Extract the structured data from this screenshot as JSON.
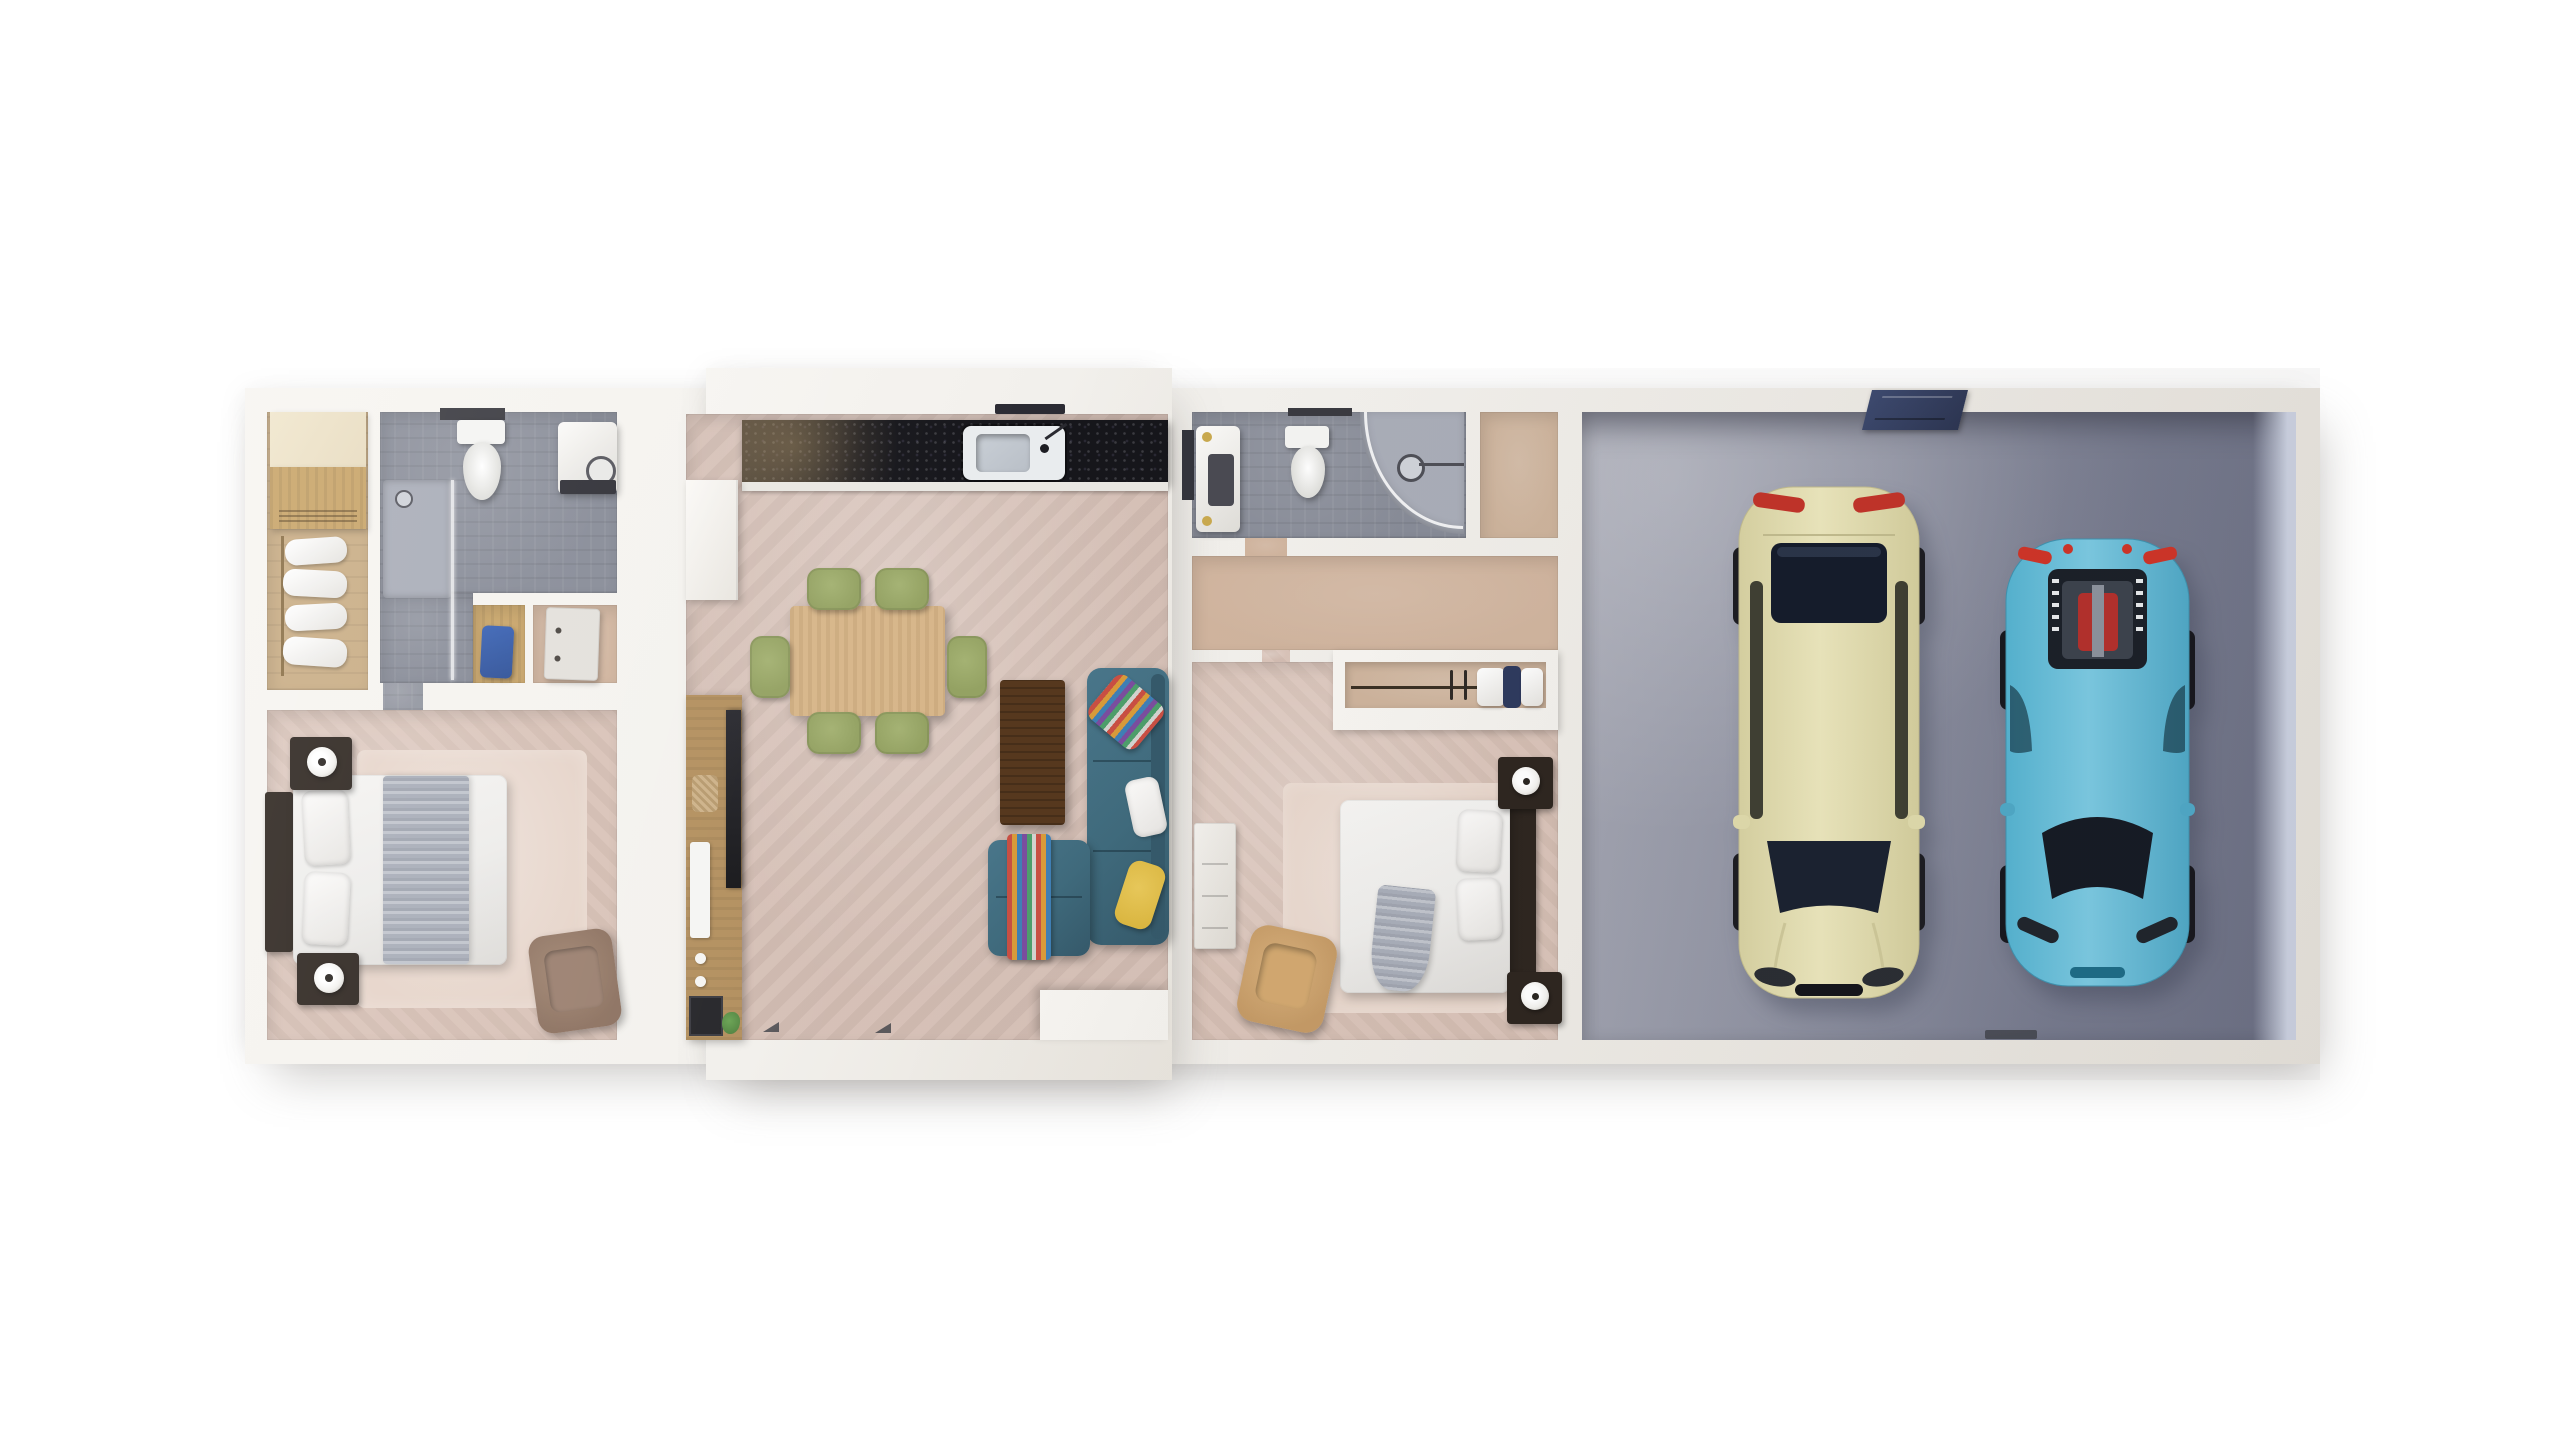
{
  "scene": {
    "title": "3D Floor Plan — Top-Down Render",
    "description": "Top-down 3D render of a single-storey home: master suite with walk-in closet and ensuite bathroom, open-plan kitchen, dining and living room, second bedroom suite with bathroom and wardrobe, and a double garage with two parked cars.",
    "style": "photorealistic architectural render on white background"
  },
  "rooms": {
    "master_closet": {
      "label": "Walk-in closet"
    },
    "master_bath": {
      "label": "Master bathroom"
    },
    "utility_nook": {
      "label": "Utility nook"
    },
    "dressing_nook": {
      "label": "Dressing nook"
    },
    "master_bedroom": {
      "label": "Master bedroom"
    },
    "kitchen": {
      "label": "Kitchen"
    },
    "dining": {
      "label": "Dining area"
    },
    "living": {
      "label": "Living room"
    },
    "bath2": {
      "label": "Second bathroom"
    },
    "closet2_room": {
      "label": "Entry closet room"
    },
    "hall2": {
      "label": "Hallway"
    },
    "wardrobe2": {
      "label": "Built-in wardrobe"
    },
    "bedroom2": {
      "label": "Second bedroom"
    },
    "garage": {
      "label": "Double garage"
    }
  },
  "furniture": {
    "wardrobe_clothes": {
      "label": "Hanging clothes"
    },
    "closet_cabinet": {
      "label": "Closet cabinetry"
    },
    "toilet": {
      "label": "Toilet"
    },
    "washer": {
      "label": "Washing machine / basin unit"
    },
    "shower": {
      "label": "Shower"
    },
    "vanity": {
      "label": "Vanity basin"
    },
    "bed": {
      "label": "Double bed"
    },
    "nightstand": {
      "label": "Nightstand with lamp"
    },
    "armchair": {
      "label": "Armchair"
    },
    "dresser": {
      "label": "Dresser"
    },
    "counter": {
      "label": "Kitchen counter (black granite)"
    },
    "sink": {
      "label": "Kitchen sink"
    },
    "hood": {
      "label": "Cooker hood"
    },
    "fridge": {
      "label": "Tall cabinet / fridge"
    },
    "tv_console": {
      "label": "TV sideboard"
    },
    "tv": {
      "label": "Television"
    },
    "dining_table": {
      "label": "Dining table with six chairs"
    },
    "coffee_table": {
      "label": "Coffee table"
    },
    "sofa": {
      "label": "Corner sofa with chaise"
    },
    "half_wall": {
      "label": "Entry half wall"
    },
    "roof_window": {
      "label": "Garage roof window"
    }
  },
  "vehicles": {
    "sedan": {
      "label": "Cream luxury sedan",
      "body_color": "#e9e4b8"
    },
    "sports_car": {
      "label": "Light-blue sports car",
      "body_color": "#66c2de"
    }
  },
  "colors": {
    "bg": "#ffffff",
    "wall": "#f2f0ec",
    "floorBedroom": "#d8c1b6",
    "floorRug": "#e6d4c9",
    "floorLiving": "#d4beb4",
    "floorHall": "#d0b49e",
    "floorTan": "#cdb39c",
    "floorWoodCloset": "#c9ad85",
    "woodLight": "#e8dcc0",
    "wood": "#c8a468",
    "floorBath": "#878b97",
    "floorBathLight": "#a9adb8",
    "garageA": "#a6a8b4",
    "garageB": "#6b6f84",
    "garageFace": "#ccd2e2",
    "counter": "#16161b",
    "sinkRim": "#e9ecee",
    "sinkBasin": "#b9bfc7",
    "tableWood": "#d7b68a",
    "chairGreen": "#94a263",
    "coffeeWood": "#56381e",
    "consoleWood": "#b3905f",
    "tvBlack": "#17171a",
    "sofa": "#3f6a7c",
    "pillowYellow": "#d9b43c",
    "duvet": "#edecea",
    "throwGray": "#a8adb8",
    "darkWood": "#2e2620",
    "lampWhite": "#f2f1ee",
    "armBrown": "#8d7261",
    "armTan": "#c49a66",
    "dresserWhite": "#e3e0db",
    "navyPanel": "#2c3552",
    "blueItem": "#2d4f96",
    "gold": "#c9a94e",
    "red": "#c23329",
    "glass": "#1a2130",
    "plant": "#4c7c3c"
  }
}
